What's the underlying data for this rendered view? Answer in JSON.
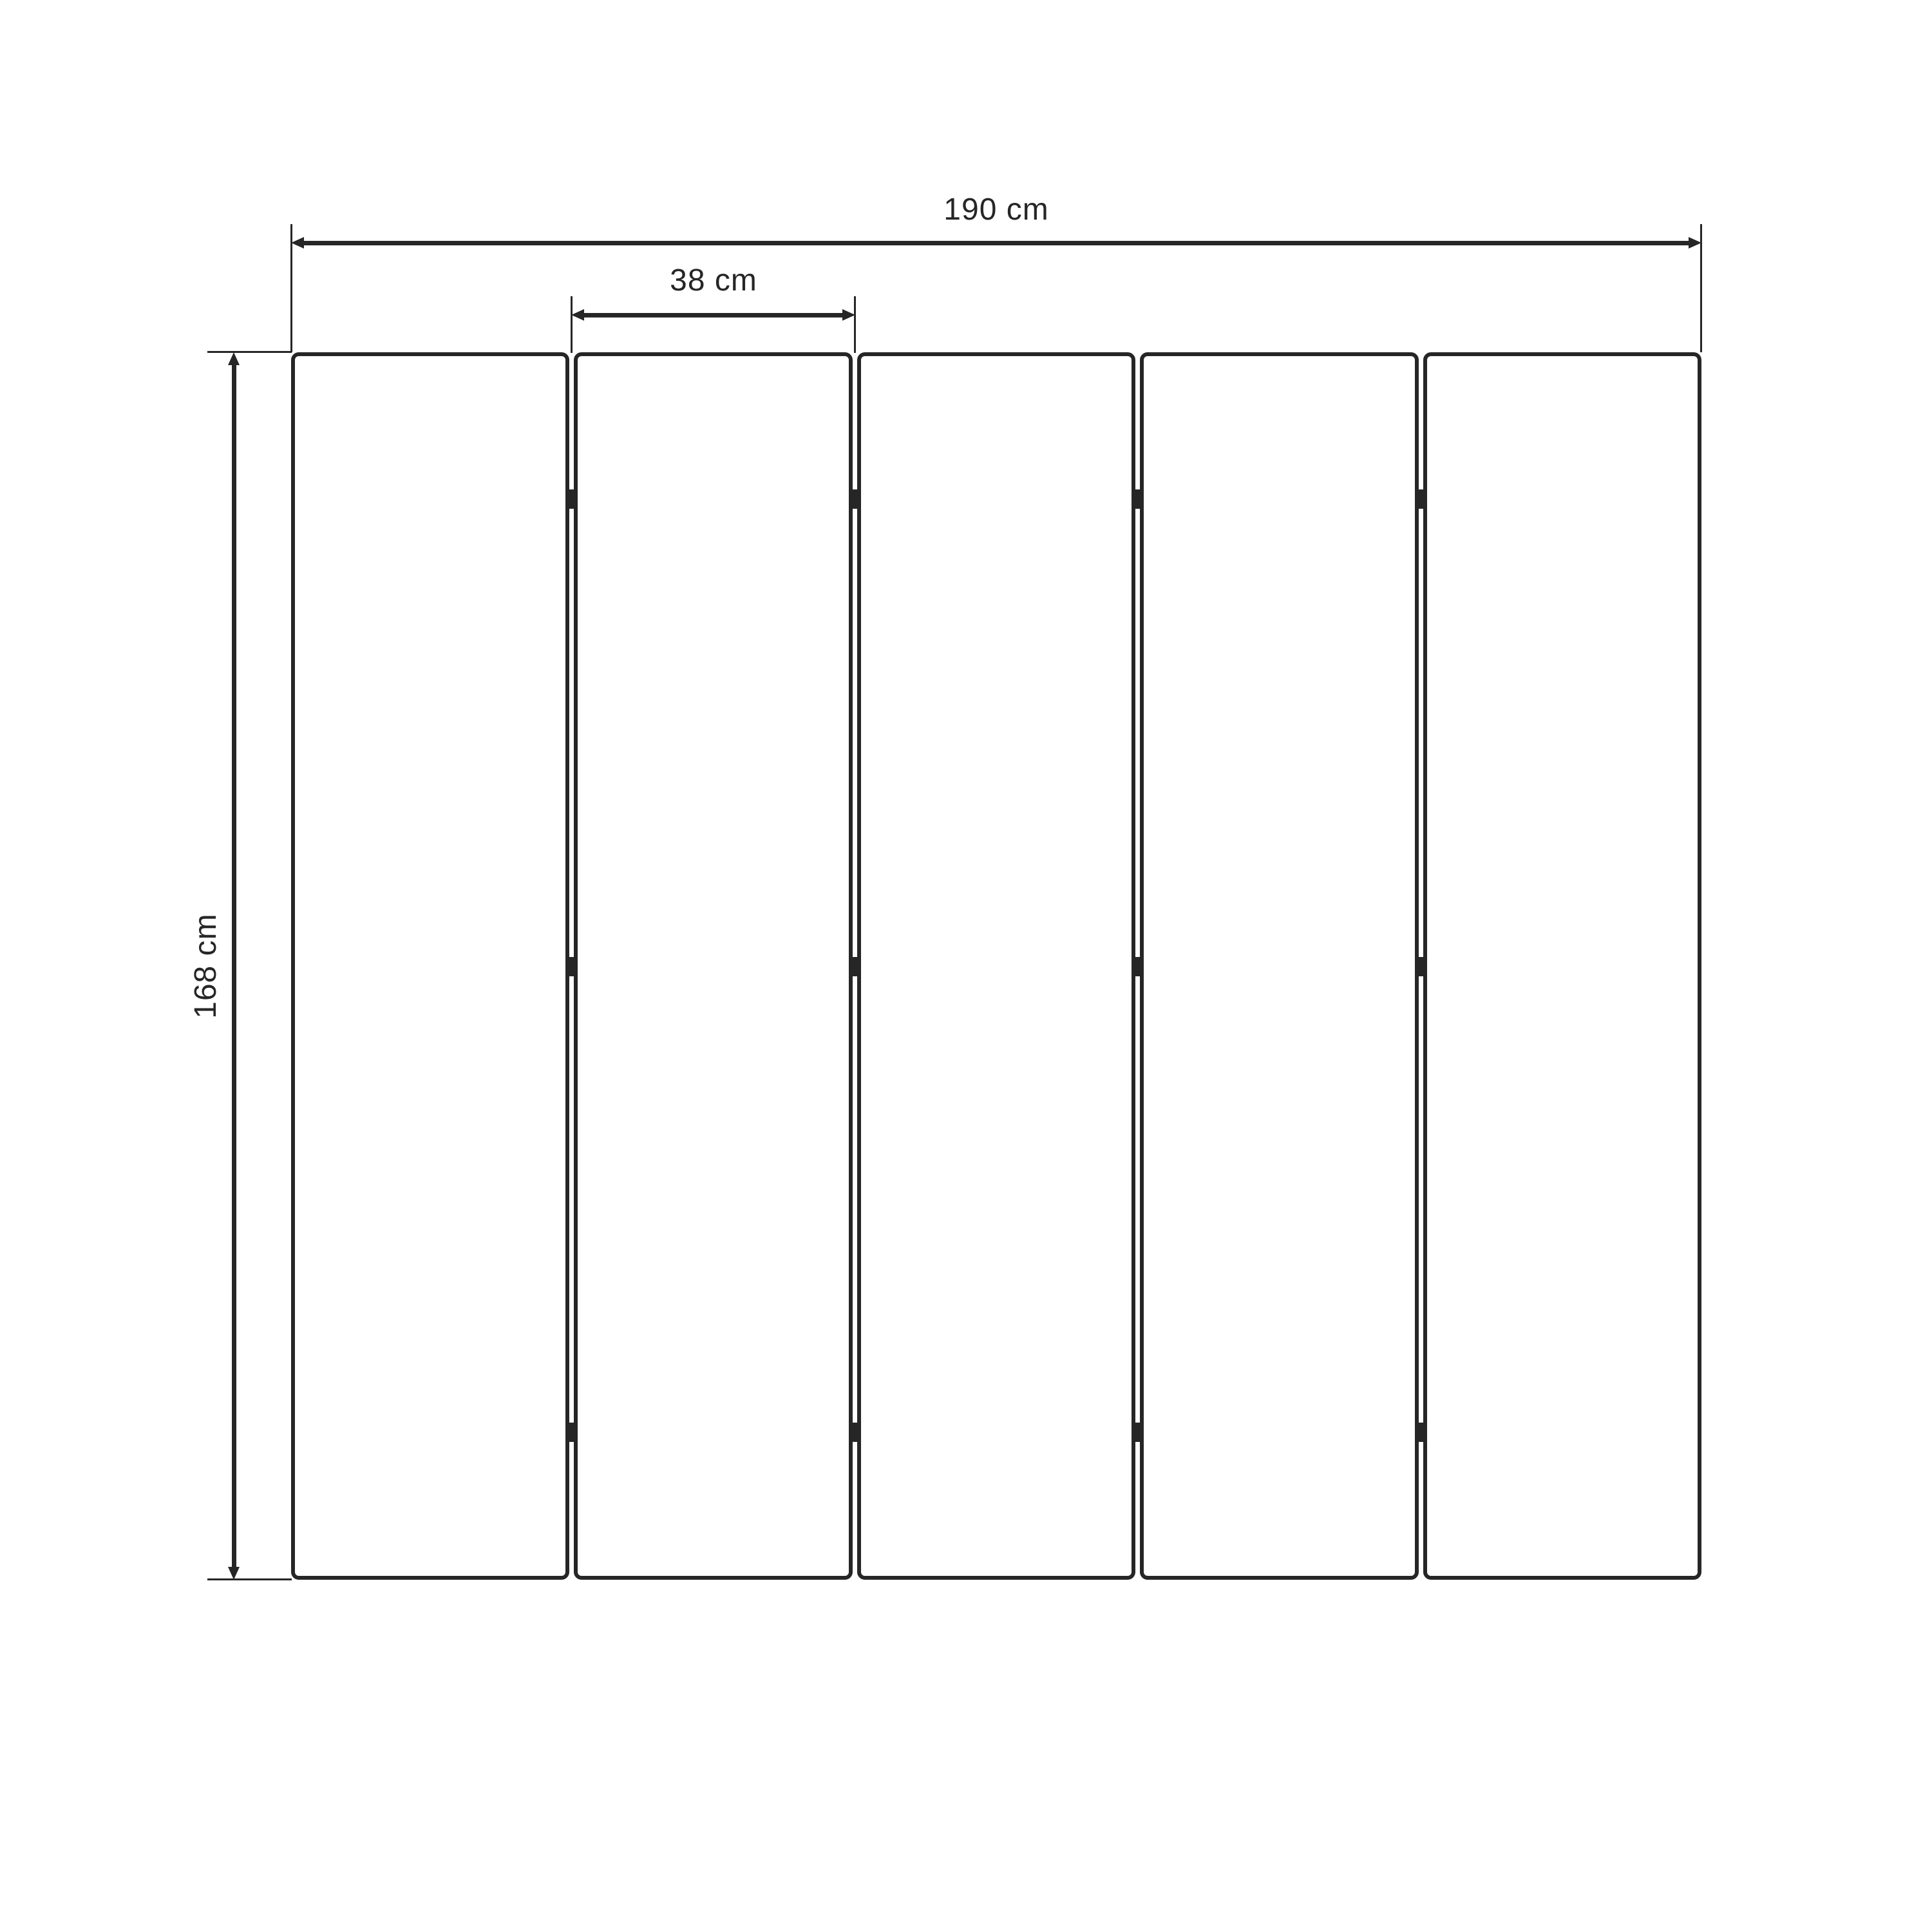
{
  "diagram": {
    "type": "dimensioned drawing of a five-panel folding screen (front view)",
    "dimensions": {
      "total_width": {
        "label": "190 cm"
      },
      "panel_width": {
        "label": "38 cm"
      },
      "height": {
        "label": "168 cm"
      }
    },
    "panels": {
      "count": 5,
      "joints": 4,
      "hinges_per_joint": 3
    },
    "colors": {
      "line": "#262626",
      "background": "#ffffff"
    }
  }
}
